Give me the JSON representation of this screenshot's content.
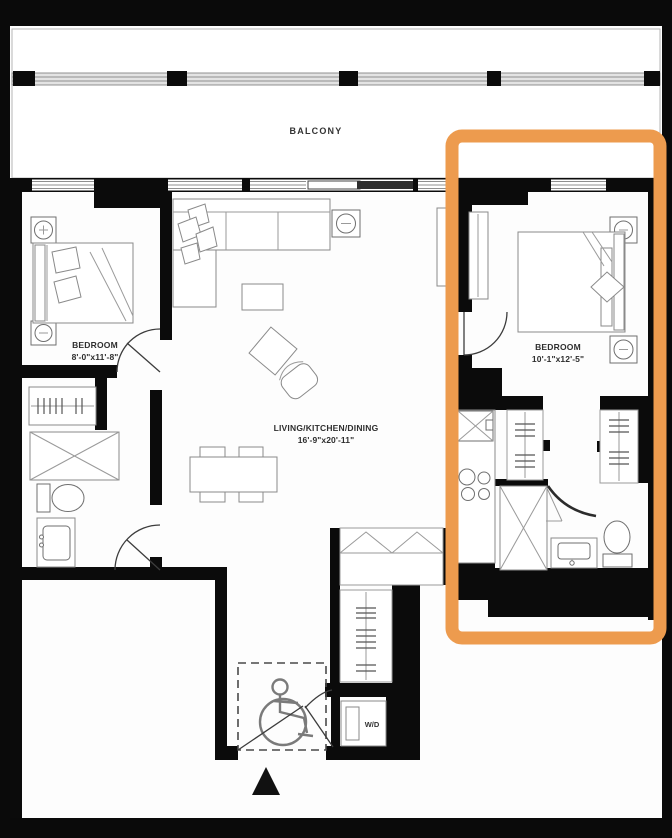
{
  "plan": {
    "balcony": {
      "label": "BALCONY"
    },
    "bedroom_left": {
      "label": "BEDROOM",
      "dims": "8'-0\"x11'-8\""
    },
    "bedroom_right": {
      "label": "BEDROOM",
      "dims": "10'-1\"x12'-5\""
    },
    "living": {
      "label": "LIVING/KITCHEN/DINING",
      "dims": "16'-9\"x20'-11\""
    },
    "laundry": {
      "label": "W/D"
    }
  },
  "highlight": {
    "color": "#ed9b4e"
  }
}
